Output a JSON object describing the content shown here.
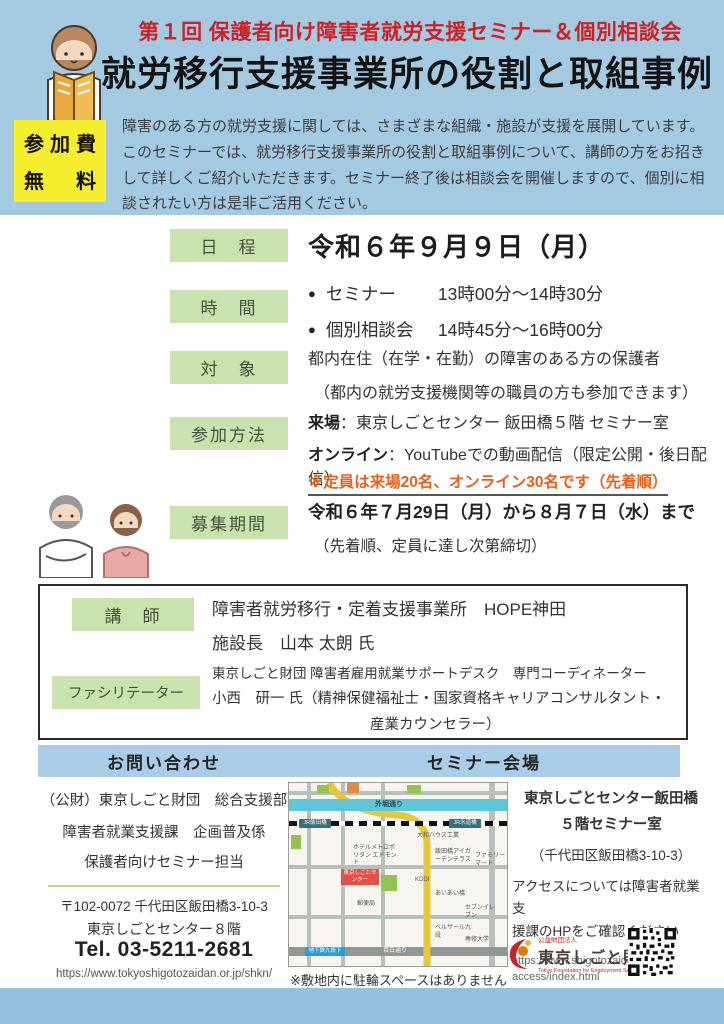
{
  "header": {
    "subtitle": "第１回 保護者向け障害者就労支援セミナー＆個別相談会",
    "title": "就労移行支援事業所の役割と取組事例",
    "fee_line1": "参加費",
    "fee_line2": "無　料",
    "intro": "障害のある方の就労支援に関しては、さまざまな組織・施設が支援を展開しています。このセミナーでは、就労移行支援事業所の役割と取組事例について、講師の方をお招きして詳しくご紹介いただきます。セミナー終了後は相談会を開催しますので、個別に相談されたい方は是非ご活用ください。"
  },
  "details": {
    "schedule": {
      "label": "日　程",
      "value": "令和６年９月９日（月）"
    },
    "time": {
      "label": "時　間",
      "rows": [
        {
          "bullet": "●",
          "name": "セミナー",
          "time": "13時00分～14時30分"
        },
        {
          "bullet": "●",
          "name": "個別相談会",
          "time": "14時45分～16時00分"
        }
      ]
    },
    "target": {
      "label": "対　象",
      "line1": "都内在住（在学・在勤）の障害のある方の保護者",
      "line2": "（都内の就労支援機関等の職員の方も参加できます）"
    },
    "participation": {
      "label": "参加方法",
      "onsite_label": "来場",
      "onsite_rest": "：東京しごとセンター 飯田橋５階 セミナー室",
      "online_label": "オンライン",
      "online_rest": "：YouTubeでの動画配信（限定公開・後日配信）",
      "note": "※定員は来場20名、オンライン30名です（先着順）"
    },
    "period": {
      "label": "募集期間",
      "line1": "令和６年７月29日（月）から８月７日（水）まで",
      "line2": "（先着順、定員に達し次第締切）"
    }
  },
  "speakers": {
    "lecturer": {
      "label": "講　師",
      "line1": "障害者就労移行・定着支援事業所　HOPE神田",
      "line2": "施設長　山本 太朗 氏"
    },
    "facilitator": {
      "label": "ファシリテーター",
      "line1": "東京しごと財団 障害者雇用就業サポートデスク　専門コーディネーター",
      "line2": "小西　研一 氏（精神保健福祉士・国家資格キャリアコンサルタント・",
      "line3": "産業カウンセラー）"
    }
  },
  "contact": {
    "header": "お問い合わせ",
    "org_lines": [
      "（公財）東京しごと財団　総合支援部",
      "障害者就業支援課　企画普及係",
      "保護者向けセミナー担当"
    ],
    "postal": "〒102-0072 千代田区飯田橋3-10-3",
    "building": "東京しごとセンター８階",
    "tel": "Tel. 03-5211-2681",
    "url": "https://www.tokyoshigotozaidan.or.jp/shkn/"
  },
  "venue": {
    "header": "セミナー会場",
    "name1": "東京しごとセンター飯田橋",
    "name2": "５階セミナー室",
    "address": "（千代田区飯田橋3-10-3）",
    "access1": "アクセスについては障害者就業支",
    "access2": "援課のHPをご確認ください",
    "url1": "https://www.shigotozaidan.or.jp/",
    "url2": "access/index.html",
    "map_note": "※敷地内に駐輪スペースはありません",
    "map_labels": {
      "sotobori": "外堀通り",
      "jr_iidabashi": "JR飯田橋",
      "jr_suidobashi": "JR水道橋",
      "daiwa_house": "大和ハウス工業",
      "hotel_edmont": "ホテルメトロポリタン エドモント",
      "iidabashi_igarden": "飯田橋アイガーデンテラス",
      "family_mart": "ファミリーマート",
      "tokyo_shigoto_center": "東京しごとセンター",
      "kddi": "KDDI",
      "aiai_bashi": "あいあい橋",
      "post_office": "郵便局",
      "bellesalle_kudan": "ベルサール九段",
      "senshu_univ": "専修大学",
      "seven_eleven": "セブンイレブン",
      "mejiro_dori": "目白通り",
      "metro_kudanshita": "地下鉄九段下"
    }
  },
  "logo": {
    "small": "公益財団法人",
    "name": "東京しごと財団",
    "english": "Tokyo Foundation for Employment Services"
  },
  "colors": {
    "band_blue": "#a4cae2",
    "header_bar_blue": "#a9cde6",
    "label_green": "#c8e3ad",
    "fee_yellow": "#f5ee2e",
    "subtitle_red": "#cc2127",
    "note_orange": "#e8611d"
  }
}
